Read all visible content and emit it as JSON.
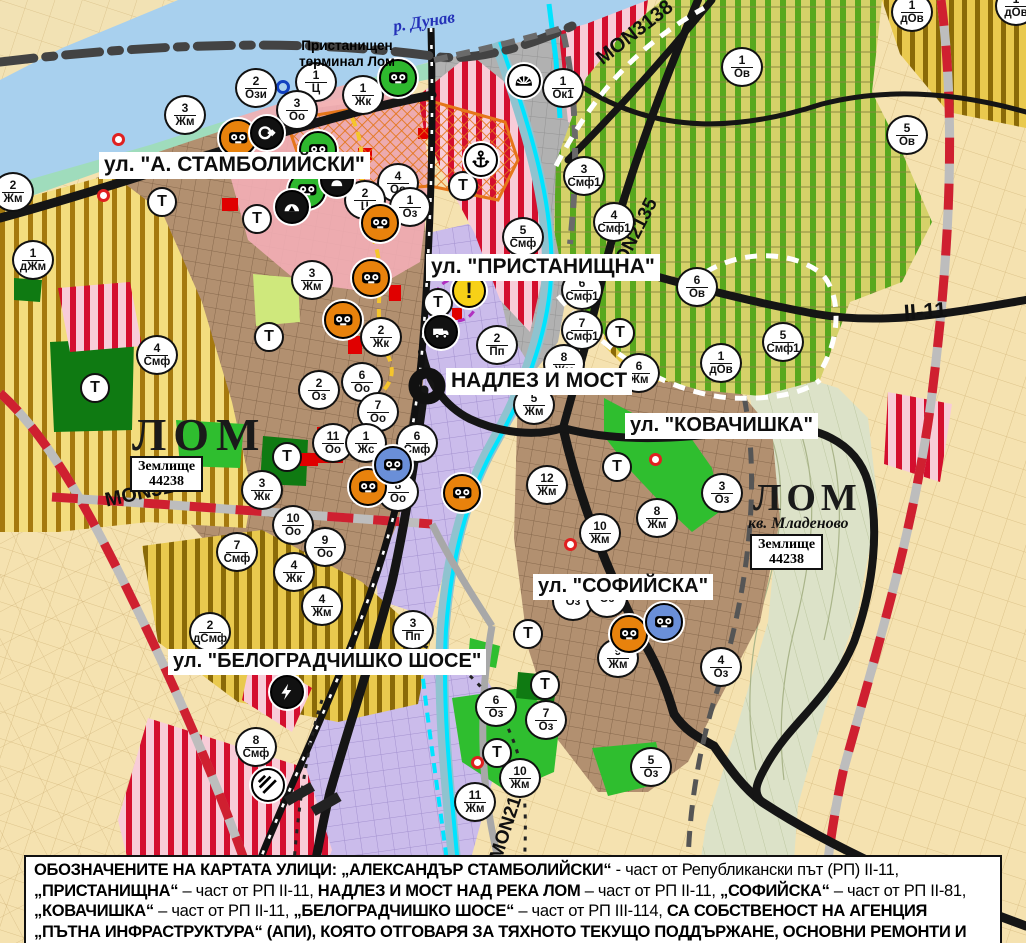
{
  "map": {
    "region_name": "ЛОМ",
    "colors": {
      "danube_water": "#a8d0ee",
      "river_teal": "#8fc3cf",
      "cyan_channel": "#00e4ff",
      "road_black": "#151515",
      "road_red_dash": "#cf2030",
      "residential_brown": "#b29070",
      "industrial_purple": "#cbbceb",
      "smf_red_stripe": "#d40f2e",
      "vineyard_green": "#58a81e",
      "yellow_zone": "#f3dd7e",
      "park_green": "#2fbe2f",
      "forest_green": "#0f7a12",
      "port_grey": "#b1b1b1",
      "center_pink": "#f3aeb6",
      "icon_bg": {
        "green": "#2eb82e",
        "orange": "#e8820c",
        "blue": "#6a8fd8",
        "black": "#111111",
        "white": "#ffffff",
        "yellow": "#f7d117"
      }
    },
    "water_labels": {
      "danube": "р. Дунав"
    },
    "port_terminal_label": "Пристанищен\nтерминал Лом",
    "lom_left": {
      "name": "ЛОМ",
      "zemlishte_line1": "Землище",
      "zemlishte_line2": "44238"
    },
    "lom_right": {
      "name": "ЛОМ",
      "district": "кв. Младеново",
      "zemlishte_line1": "Землище",
      "zemlishte_line2": "44238"
    },
    "street_labels": [
      {
        "text": "ул. \"А. СТАМБОЛИЙСКИ\"",
        "x": 99,
        "y": 152,
        "fs": 21
      },
      {
        "text": "ул. \"ПРИСТАНИЩНА\"",
        "x": 426,
        "y": 254,
        "fs": 21
      },
      {
        "text": "НАДЛЕЗ И МОСТ",
        "x": 446,
        "y": 368,
        "fs": 21
      },
      {
        "text": "ул. \"КОВАЧИШКА\"",
        "x": 625,
        "y": 413,
        "fs": 20
      },
      {
        "text": "ул. \"СОФИЙСКА\"",
        "x": 533,
        "y": 574,
        "fs": 20
      },
      {
        "text": "ул. \"БЕЛОГРАДЧИШКО ШОСЕ\"",
        "x": 168,
        "y": 649,
        "fs": 20
      }
    ],
    "road_labels": [
      {
        "text": "MON3139",
        "x": 103,
        "y": 490,
        "rotate": -12,
        "fs": 20
      },
      {
        "text": "MON3138",
        "x": 592,
        "y": 52,
        "rotate": -38,
        "fs": 20
      },
      {
        "text": "MON2135",
        "x": 604,
        "y": 272,
        "rotate": -63,
        "fs": 19
      },
      {
        "text": "MON2136",
        "x": 486,
        "y": 856,
        "rotate": -72,
        "fs": 19
      },
      {
        "text": "II-11",
        "x": 903,
        "y": 300,
        "rotate": -4,
        "fs": 22
      }
    ],
    "t_label": "Т",
    "warning_label": "!",
    "zone_markers": [
      {
        "x": 256,
        "y": 88,
        "num": "2",
        "code": "Ози"
      },
      {
        "x": 316,
        "y": 82,
        "num": "1",
        "code": "Ц"
      },
      {
        "x": 297,
        "y": 110,
        "num": "3",
        "code": "Оо"
      },
      {
        "x": 363,
        "y": 95,
        "num": "1",
        "code": "Жк"
      },
      {
        "x": 185,
        "y": 115,
        "num": "3",
        "code": "Жм"
      },
      {
        "x": 13,
        "y": 192,
        "num": "2",
        "code": "Жм"
      },
      {
        "x": 33,
        "y": 260,
        "num": "1",
        "code": "дЖм"
      },
      {
        "x": 398,
        "y": 183,
        "num": "4",
        "code": "Оо"
      },
      {
        "x": 365,
        "y": 200,
        "num": "2",
        "code": "Ц"
      },
      {
        "x": 410,
        "y": 207,
        "num": "1",
        "code": "Оз"
      },
      {
        "x": 312,
        "y": 280,
        "num": "3",
        "code": "Жм"
      },
      {
        "x": 381,
        "y": 337,
        "num": "2",
        "code": "Жк"
      },
      {
        "x": 362,
        "y": 382,
        "num": "6",
        "code": "Оо"
      },
      {
        "x": 319,
        "y": 390,
        "num": "2",
        "code": "Оз"
      },
      {
        "x": 378,
        "y": 412,
        "num": "7",
        "code": "Оо"
      },
      {
        "x": 333,
        "y": 443,
        "num": "11",
        "code": "Оо"
      },
      {
        "x": 366,
        "y": 443,
        "num": "1",
        "code": "Жс"
      },
      {
        "x": 417,
        "y": 443,
        "num": "6",
        "code": "Смф"
      },
      {
        "x": 398,
        "y": 492,
        "num": "8",
        "code": "Оо"
      },
      {
        "x": 262,
        "y": 490,
        "num": "3",
        "code": "Жк"
      },
      {
        "x": 293,
        "y": 525,
        "num": "10",
        "code": "Оо"
      },
      {
        "x": 325,
        "y": 547,
        "num": "9",
        "code": "Оо"
      },
      {
        "x": 294,
        "y": 572,
        "num": "4",
        "code": "Жк"
      },
      {
        "x": 322,
        "y": 606,
        "num": "4",
        "code": "Жм"
      },
      {
        "x": 237,
        "y": 552,
        "num": "7",
        "code": "Смф"
      },
      {
        "x": 210,
        "y": 632,
        "num": "2",
        "code": "дСмф"
      },
      {
        "x": 413,
        "y": 630,
        "num": "3",
        "code": "Пп"
      },
      {
        "x": 256,
        "y": 747,
        "num": "8",
        "code": "Смф"
      },
      {
        "x": 157,
        "y": 355,
        "num": "4",
        "code": "Смф"
      },
      {
        "x": 563,
        "y": 88,
        "num": "1",
        "code": "Ок1"
      },
      {
        "x": 584,
        "y": 176,
        "num": "3",
        "code": "Смф1"
      },
      {
        "x": 614,
        "y": 222,
        "num": "4",
        "code": "Смф1"
      },
      {
        "x": 582,
        "y": 290,
        "num": "6",
        "code": "Смф1"
      },
      {
        "x": 582,
        "y": 330,
        "num": "7",
        "code": "Смф1"
      },
      {
        "x": 564,
        "y": 364,
        "num": "8",
        "code": "Жм"
      },
      {
        "x": 534,
        "y": 405,
        "num": "5",
        "code": "Жм"
      },
      {
        "x": 639,
        "y": 373,
        "num": "6",
        "code": "Жм"
      },
      {
        "x": 523,
        "y": 237,
        "num": "5",
        "code": "Смф"
      },
      {
        "x": 497,
        "y": 345,
        "num": "2",
        "code": "Пп"
      },
      {
        "x": 742,
        "y": 67,
        "num": "1",
        "code": "Ов"
      },
      {
        "x": 907,
        "y": 135,
        "num": "5",
        "code": "Ов"
      },
      {
        "x": 912,
        "y": 12,
        "num": "1",
        "code": "дОв"
      },
      {
        "x": 1016,
        "y": 6,
        "num": "1",
        "code": "дОв"
      },
      {
        "x": 697,
        "y": 287,
        "num": "6",
        "code": "Ов"
      },
      {
        "x": 721,
        "y": 363,
        "num": "1",
        "code": "дОв"
      },
      {
        "x": 783,
        "y": 342,
        "num": "5",
        "code": "Смф1"
      },
      {
        "x": 547,
        "y": 485,
        "num": "12",
        "code": "Жм"
      },
      {
        "x": 600,
        "y": 533,
        "num": "10",
        "code": "Жм"
      },
      {
        "x": 657,
        "y": 518,
        "num": "8",
        "code": "Жм"
      },
      {
        "x": 722,
        "y": 493,
        "num": "3",
        "code": "Оз"
      },
      {
        "x": 573,
        "y": 601,
        "num": "",
        "code": "Оз"
      },
      {
        "x": 607,
        "y": 598,
        "num": "",
        "code": "Оз"
      },
      {
        "x": 618,
        "y": 658,
        "num": "9",
        "code": "Жм"
      },
      {
        "x": 721,
        "y": 667,
        "num": "4",
        "code": "Оз"
      },
      {
        "x": 546,
        "y": 720,
        "num": "7",
        "code": "Оз"
      },
      {
        "x": 496,
        "y": 707,
        "num": "6",
        "code": "Оз"
      },
      {
        "x": 651,
        "y": 767,
        "num": "5",
        "code": "Оз"
      },
      {
        "x": 520,
        "y": 778,
        "num": "10",
        "code": "Жм"
      },
      {
        "x": 475,
        "y": 802,
        "num": "11",
        "code": "Жм"
      }
    ],
    "t_markers": [
      {
        "x": 162,
        "y": 202
      },
      {
        "x": 257,
        "y": 219
      },
      {
        "x": 269,
        "y": 337
      },
      {
        "x": 287,
        "y": 457
      },
      {
        "x": 95,
        "y": 388
      },
      {
        "x": 438,
        "y": 303
      },
      {
        "x": 463,
        "y": 186
      },
      {
        "x": 620,
        "y": 333
      },
      {
        "x": 617,
        "y": 467
      },
      {
        "x": 528,
        "y": 634
      },
      {
        "x": 545,
        "y": 685
      },
      {
        "x": 497,
        "y": 753
      }
    ],
    "icon_markers": [
      {
        "x": 398,
        "y": 78,
        "type": "culture",
        "bg": "green"
      },
      {
        "x": 318,
        "y": 150,
        "type": "culture",
        "bg": "green"
      },
      {
        "x": 307,
        "y": 190,
        "type": "culture",
        "bg": "green"
      },
      {
        "x": 238,
        "y": 138,
        "type": "culture",
        "bg": "orange"
      },
      {
        "x": 371,
        "y": 278,
        "type": "culture",
        "bg": "orange"
      },
      {
        "x": 343,
        "y": 320,
        "type": "culture",
        "bg": "orange"
      },
      {
        "x": 380,
        "y": 223,
        "type": "culture",
        "bg": "orange"
      },
      {
        "x": 368,
        "y": 487,
        "type": "culture",
        "bg": "orange"
      },
      {
        "x": 629,
        "y": 634,
        "type": "culture",
        "bg": "orange"
      },
      {
        "x": 462,
        "y": 493,
        "type": "culture",
        "bg": "orange"
      },
      {
        "x": 393,
        "y": 465,
        "type": "culture",
        "bg": "blue"
      },
      {
        "x": 664,
        "y": 622,
        "type": "culture",
        "bg": "blue"
      },
      {
        "x": 267,
        "y": 133,
        "type": "arrow",
        "bg": "black"
      },
      {
        "x": 337,
        "y": 180,
        "type": "person",
        "bg": "black"
      },
      {
        "x": 292,
        "y": 207,
        "type": "mountain",
        "bg": "black"
      },
      {
        "x": 524,
        "y": 81,
        "type": "sun",
        "bg": "white"
      },
      {
        "x": 481,
        "y": 160,
        "type": "anchor",
        "bg": "white"
      },
      {
        "x": 441,
        "y": 332,
        "type": "truck",
        "bg": "black"
      },
      {
        "x": 287,
        "y": 692,
        "type": "lightning",
        "bg": "black"
      },
      {
        "x": 268,
        "y": 785,
        "type": "crossing",
        "bg": "white"
      },
      {
        "x": 469,
        "y": 291,
        "type": "warning",
        "bg": "yellow"
      }
    ],
    "red_dots": [
      {
        "x": 118,
        "y": 139
      },
      {
        "x": 103,
        "y": 195
      },
      {
        "x": 570,
        "y": 544
      },
      {
        "x": 655,
        "y": 459
      },
      {
        "x": 477,
        "y": 762
      }
    ],
    "blue_rings": [
      {
        "x": 283,
        "y": 87
      }
    ],
    "caption": {
      "segments": [
        {
          "b": true,
          "t": "ОБОЗНАЧЕНИТЕ НА КАРТАТА УЛИЦИ: „АЛЕКСАНДЪР СТАМБОЛИЙСКИ“"
        },
        {
          "b": false,
          "t": " - част от Републикански път (РП) II-11, "
        },
        {
          "b": true,
          "t": "„ПРИСТАНИЩНА“"
        },
        {
          "b": false,
          "t": " – част от РП II-11, "
        },
        {
          "b": true,
          "t": "НАДЛЕЗ И МОСТ НАД РЕКА ЛОМ"
        },
        {
          "b": false,
          "t": " – част от РП II-11, "
        },
        {
          "b": true,
          "t": "„СОФИЙСКА“"
        },
        {
          "b": false,
          "t": " – част от РП II-81, "
        },
        {
          "b": true,
          "t": "„КОВАЧИШКА“"
        },
        {
          "b": false,
          "t": " – част от РП II-11, "
        },
        {
          "b": true,
          "t": "„БЕЛОГРАДЧИШКО ШОСЕ“"
        },
        {
          "b": false,
          "t": " – част от РП III-114, "
        },
        {
          "b": true,
          "t": "СА СОБСТВЕНОСТ НА АГЕНЦИЯ „ПЪТНА ИНФРАСТРУКТУРА“ (АПИ), КОЯТО ОТГОВАРЯ ЗА ТЯХНОТО ТЕКУЩО ПОДДЪРЖАНЕ, ОСНОВНИ РЕМОНТИ И РАЗРЕШИТЕЛНИ РЕЖИМИ."
        }
      ]
    }
  }
}
